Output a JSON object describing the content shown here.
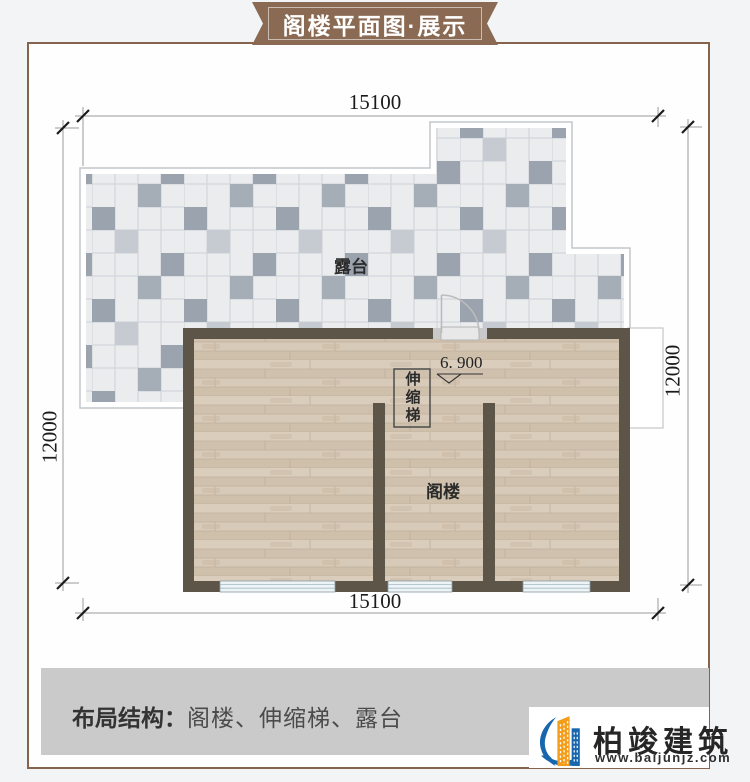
{
  "banner": {
    "title": "阁楼平面图·展示"
  },
  "plan": {
    "dimensions": {
      "top": "15100",
      "bottom": "15100",
      "left": "12000",
      "right": "12000"
    },
    "rooms": {
      "terrace": "露台",
      "attic": "阁楼",
      "stairs": "伸缩梯"
    },
    "elevation": "6. 900"
  },
  "footer": {
    "label": "布局结构：",
    "value": "阁楼、伸缩梯、露台"
  },
  "brand": {
    "name": "柏竣建筑",
    "website": "www.baijunjz.com"
  },
  "colors": {
    "frame_brown": "#85634c",
    "ribbon_brown": "#8a6a52",
    "wall_dark": "#5d5548",
    "wood_floor": "#d6c7b5",
    "tile_light": "#eaecee",
    "tile_dark": "#9ba4ae",
    "window_blue": "#eef3f6",
    "footer_gray": "#cacaca",
    "logo_blue": "#1866ae",
    "logo_orange": "#f49d1a"
  }
}
